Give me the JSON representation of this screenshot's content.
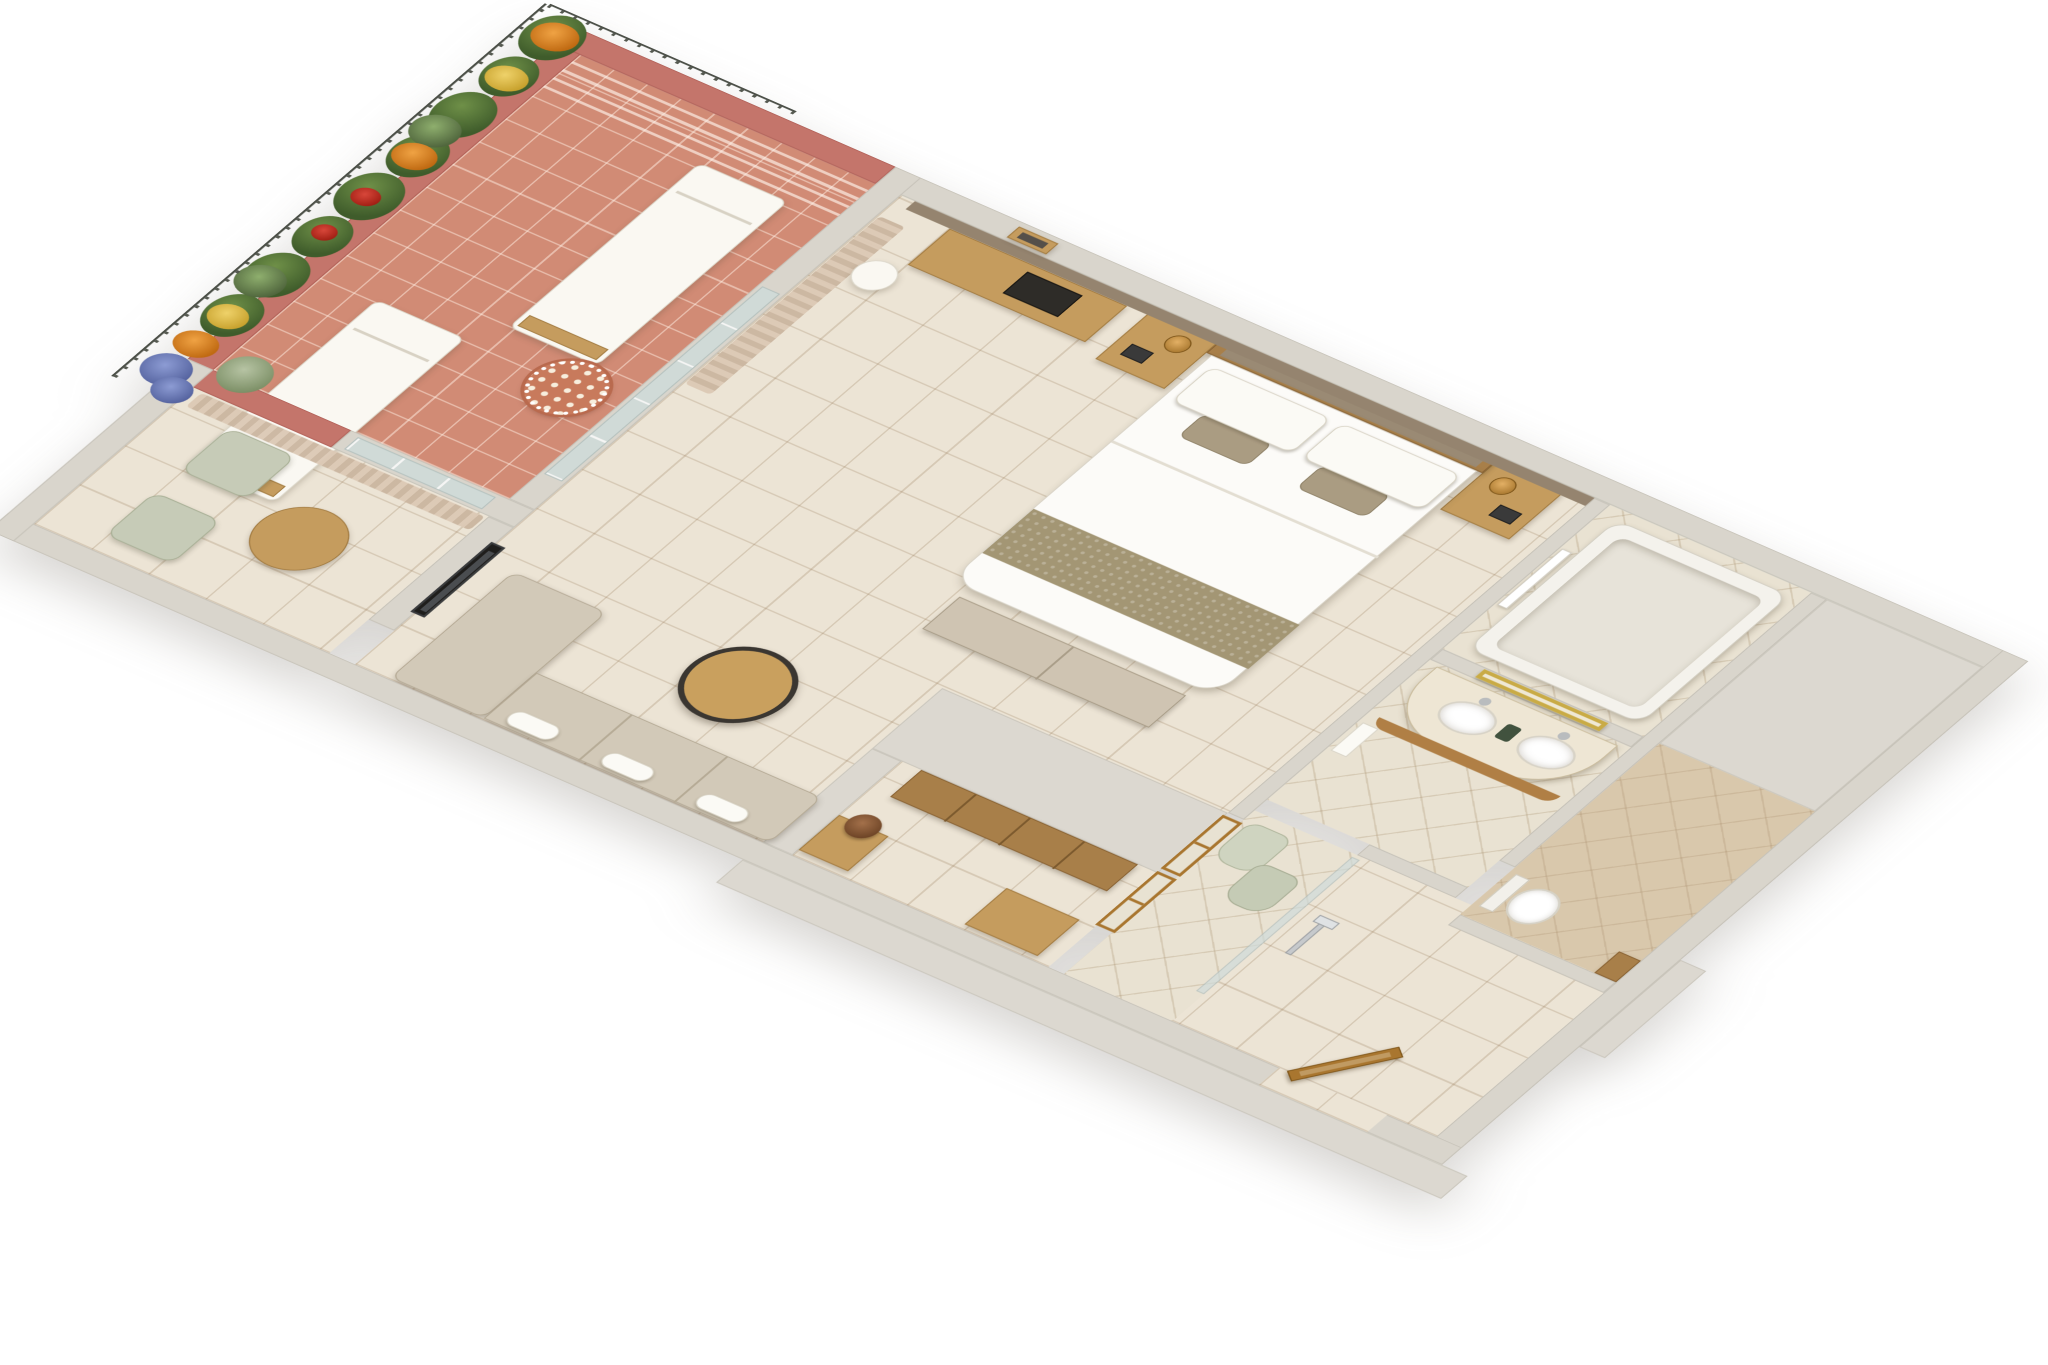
{
  "scene": {
    "kind": "3d-isometric-hotel-room-floor-plan",
    "background_color": "#ffffff",
    "visible_text": "",
    "rooms": [
      {
        "name": "terrace",
        "floor": "terracotta-tile",
        "features": [
          "planter-wall-with-flowers",
          "railing",
          "sun-lounger",
          "sun-lounger",
          "mosaic-side-table",
          "corner-plant",
          "low-parapet-blue-flowers"
        ]
      },
      {
        "name": "bedroom",
        "floor": "cream-tile",
        "features": [
          "king-bed",
          "headboard",
          "nightstand-left",
          "nightstand-right",
          "telephone",
          "table-lamp",
          "desk",
          "desk-tray",
          "stool",
          "picture-frame",
          "foot-bench",
          "sofa",
          "chaise",
          "coffee-table",
          "flower-side-table",
          "tv-partition",
          "curtains",
          "sliding-glass-door",
          "taupe-accent-wall"
        ]
      },
      {
        "name": "sitting-nook",
        "floor": "cream-tile",
        "features": [
          "armchair",
          "armchair",
          "round-table",
          "window-to-terrace",
          "curtains"
        ]
      },
      {
        "name": "bathroom",
        "floor": "diamond-tile",
        "features": [
          "bathtub",
          "towel-rack",
          "double-vanity",
          "sink",
          "sink",
          "gold-framed-mirror",
          "hanging-towel",
          "bathrobe",
          "bathrobe",
          "shower-glass-panel",
          "hand-shower"
        ]
      },
      {
        "name": "water-closet",
        "floor": "warm-tile",
        "features": [
          "toilet",
          "wood-shelf"
        ]
      },
      {
        "name": "entry-corridor",
        "floor": "cream-tile",
        "features": [
          "entrance-door-ajar",
          "interior-french-doors",
          "wardrobe",
          "luggage-bench",
          "structural-wall-block"
        ]
      }
    ]
  },
  "palette": {
    "wall_light": "#d9d5cc",
    "wall_flat": "#dcd8d0",
    "wall_pink": "#c4756b",
    "accent_taupe": "#95846f",
    "floor_cream": "#ece4d5",
    "floor_terracotta": "#d18b75",
    "floor_diamond": "#e9e2d2",
    "floor_wc": "#d9c8ac",
    "wood_light": "#c59c5e",
    "wood_dark": "#a87f49",
    "linen_white": "#fbfaf5",
    "sofa_beige": "#d2c9b8",
    "sage_green": "#c6cbb7",
    "hedge_green": "#3f5c2b",
    "flower_orange": "#e08a2a",
    "flower_yellow": "#e7c75a",
    "flower_red": "#c23324",
    "flower_blue": "#6d7fc0",
    "mirror_gold": "#c9ab46",
    "tv_black": "#1f1e1c"
  }
}
